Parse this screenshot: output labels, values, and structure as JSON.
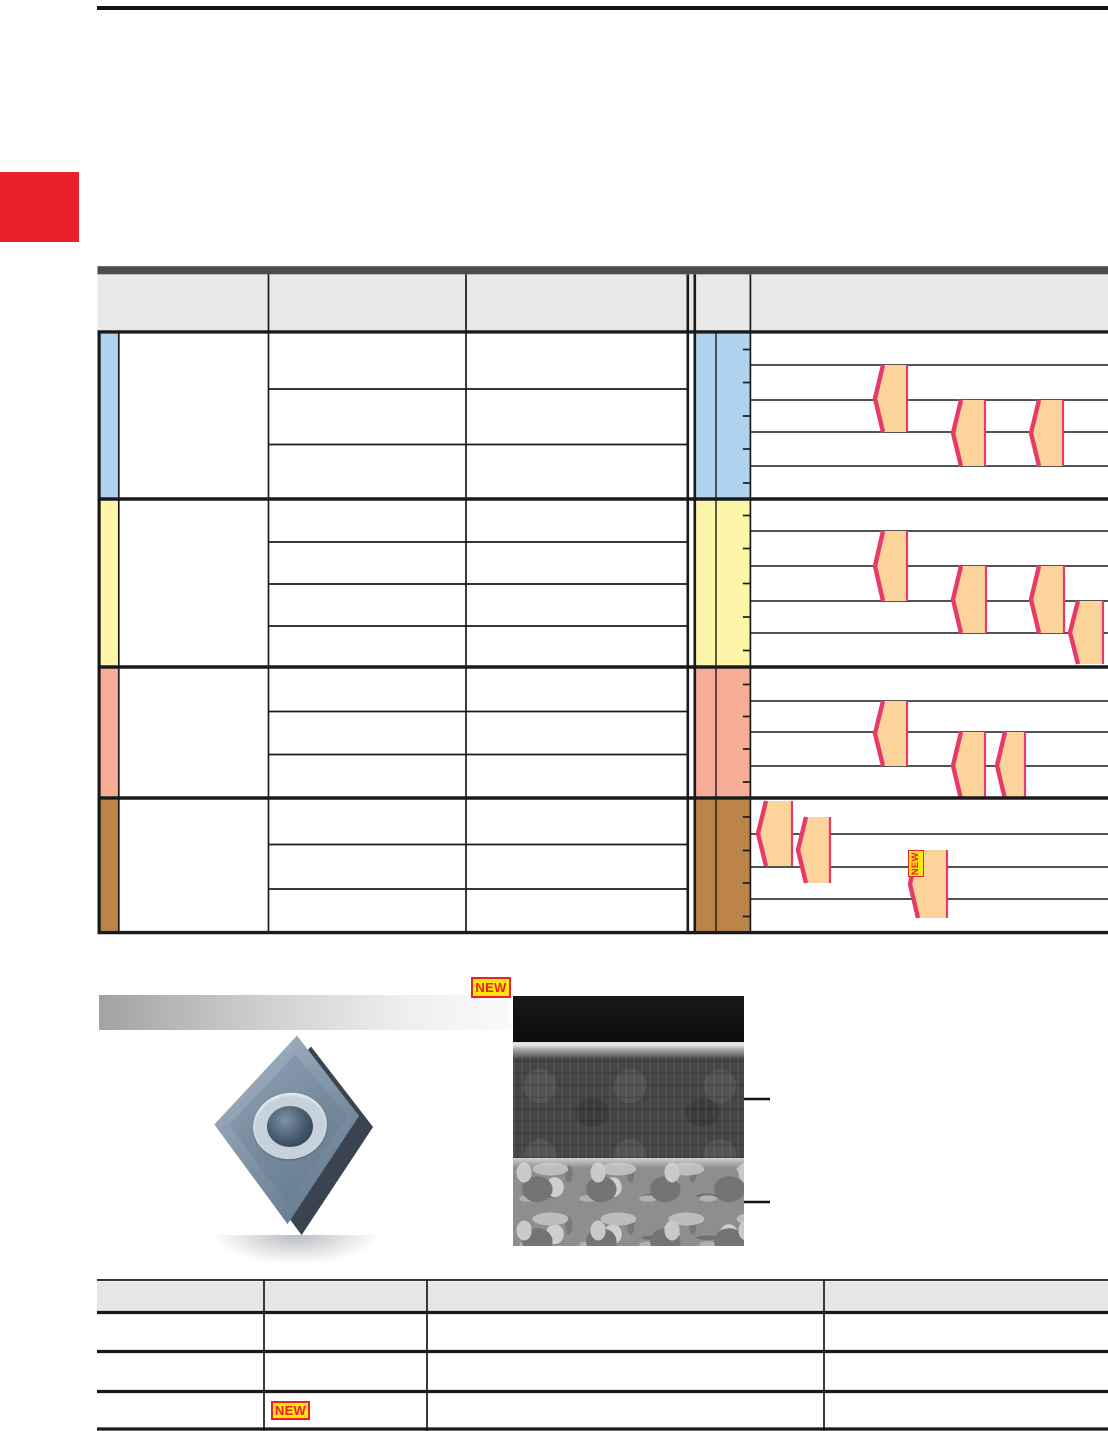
{
  "page": {
    "width": 1108,
    "height": 1431,
    "background": "#ffffff",
    "accent_red": "#E9212C",
    "line_color": "#1A1A1A",
    "note": "PDF catalog page rendered without embedded text; only NEW badges carry visible text"
  },
  "badges": {
    "bg": "#FFE60A",
    "fg": "#E8222D",
    "items": [
      {
        "id": "figure-top",
        "label": "NEW",
        "x": 471,
        "y": 977,
        "w": 40,
        "h": 21,
        "vertical": false
      },
      {
        "id": "chart-range",
        "label": "NEW",
        "x": 908,
        "y": 850,
        "w": 15.5,
        "h": 27,
        "vertical": true
      },
      {
        "id": "bottom-table",
        "label": "NEW",
        "x": 271,
        "y": 1401,
        "w": 39,
        "h": 19,
        "vertical": false
      }
    ]
  },
  "grade_table": {
    "left": 97.5,
    "right": 1108,
    "header_bar": {
      "y": 266.2,
      "h": 8.2,
      "color": "#4B4B4B"
    },
    "header_row": {
      "y": 274.4,
      "h": 55.8,
      "color": "#E8E8E8"
    },
    "header_body_divider_y": 331.9,
    "col_x": {
      "strip_right": 118.8,
      "c1": 268.5,
      "c2": 466,
      "c3_right": 687.8,
      "double_line_2": 694.8,
      "iso_left": 695.8,
      "iso_mid": 716,
      "chart_left": 750.4
    },
    "tick_len": 7.5,
    "range_fill": "#FCD39B",
    "range_stroke": "#E83A68",
    "section_boundaries": [
      499,
      667,
      798,
      932.6
    ],
    "sections": [
      {
        "id": "section-blue",
        "color": "#AFD3EE",
        "top": 333.6,
        "bottom": 497.3,
        "row_lines": [
          389,
          444.5
        ],
        "gridlines": [
          365,
          400,
          432,
          466
        ],
        "ticks": [
          349.5,
          382.5,
          416,
          449,
          483
        ],
        "ranges": [
          {
            "x": 875,
            "r": 907,
            "t": 365,
            "b": 432
          },
          {
            "x": 953,
            "r": 985,
            "t": 400,
            "b": 466
          },
          {
            "x": 1031,
            "r": 1063,
            "t": 400,
            "b": 466
          }
        ]
      },
      {
        "id": "section-yellow",
        "color": "#FDF6A8",
        "top": 500.7,
        "bottom": 665.3,
        "row_lines": [
          542,
          584,
          626
        ],
        "gridlines": [
          531,
          566,
          601,
          633
        ],
        "ticks": [
          515.5,
          548.5,
          583.5,
          617,
          650.5
        ],
        "ranges": [
          {
            "x": 875,
            "r": 907,
            "t": 531,
            "b": 601
          },
          {
            "x": 953,
            "r": 986,
            "t": 566,
            "b": 633
          },
          {
            "x": 1031,
            "r": 1064,
            "t": 566,
            "b": 633
          },
          {
            "x": 1070,
            "r": 1103,
            "t": 601,
            "b": 664
          }
        ]
      },
      {
        "id": "section-salmon",
        "color": "#F7AC96",
        "top": 668.7,
        "bottom": 796.3,
        "row_lines": [
          711.5,
          754.5
        ],
        "gridlines": [
          701,
          732,
          766
        ],
        "ticks": [
          684.5,
          716.5,
          749,
          782
        ],
        "ranges": [
          {
            "x": 875,
            "r": 907,
            "t": 701,
            "b": 766
          },
          {
            "x": 953,
            "r": 985,
            "t": 732,
            "b": 799
          },
          {
            "x": 997,
            "r": 1025,
            "t": 732,
            "b": 799
          }
        ]
      },
      {
        "id": "section-brown",
        "color": "#BC8449",
        "top": 799.7,
        "bottom": 930.9,
        "row_lines": [
          844.5,
          889
        ],
        "gridlines": [
          834,
          867,
          899
        ],
        "ticks": [
          817,
          850.5,
          883,
          916.5
        ],
        "ranges": [
          {
            "x": 758,
            "r": 792,
            "t": 801,
            "b": 866
          },
          {
            "x": 798,
            "r": 830,
            "t": 817,
            "b": 883
          },
          {
            "x": 910,
            "r": 947,
            "t": 850,
            "b": 918
          }
        ]
      }
    ]
  },
  "figure": {
    "banner": {
      "x": 99,
      "y": 995,
      "w": 412,
      "h": 35
    },
    "insert_photo": {
      "x": 203,
      "y": 1027,
      "w": 188,
      "h": 212
    },
    "sem_image": {
      "x": 513,
      "y": 996,
      "w": 231,
      "h": 250
    },
    "callouts": [
      {
        "cx": 688,
        "cy": 1099,
        "r": 5.5,
        "style": "ring",
        "line_end": 770
      },
      {
        "cx": 687,
        "cy": 1202,
        "r": 5,
        "style": "dot",
        "line_end": 770
      }
    ]
  },
  "bottom_table": {
    "left": 97,
    "right": 1108,
    "top_line": 1280,
    "header": {
      "y": 1281.5,
      "h": 30,
      "color": "#E6E6E6"
    },
    "row_lines": [
      1312.5,
      1351.5,
      1391.5,
      1429
    ],
    "col_lines": [
      264,
      427,
      824
    ]
  }
}
